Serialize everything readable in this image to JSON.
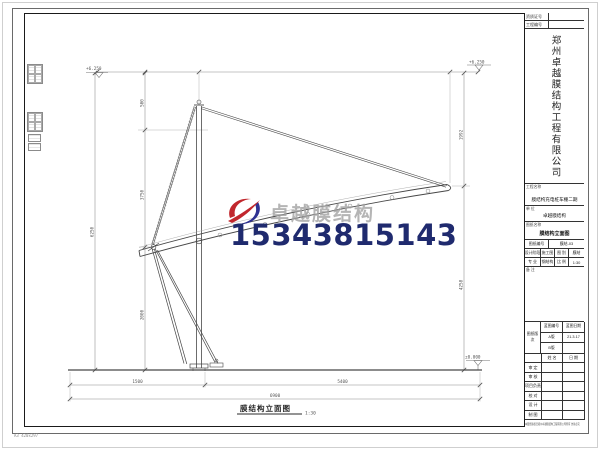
{
  "watermark": {
    "brand": "卓越膜结构",
    "phone": "15343815143",
    "brand_color": "#a3a3a3",
    "phone_color": "#1f2a6e",
    "logo_red": "#c1272d",
    "logo_blue": "#2e3192"
  },
  "drawing": {
    "caption": "膜结构立面图",
    "scale": "1:30",
    "elevations": {
      "top_left": "+6.250",
      "top_right": "+6.250",
      "ground": "±0.000"
    },
    "dims": {
      "left_total": "6250",
      "left_seg_top": "500",
      "left_seg_mid": "3750",
      "left_seg_bot": "2000",
      "right_seg_top": "1992",
      "right_seg_bot": "4258",
      "bottom_left": "1500",
      "bottom_right": "5400",
      "bottom_total": "6900"
    }
  },
  "title_block": {
    "cert_label": "资质证号",
    "cert_value": "",
    "proj_no_label": "工程编号",
    "proj_no_value": "",
    "company": "郑州卓越膜结构工程有限公司",
    "project_label": "工程名称",
    "project_value": "膜结构充电桩车棚二期",
    "unit_label": "单 位",
    "unit_value": "卓越膜结构",
    "sheet_label": "图纸名称",
    "sheet_value": "膜结构立面图",
    "grid": {
      "drawing_no_label": "图纸编号",
      "drawing_no": "膜结-03",
      "stage_label": "设计阶段",
      "stage": "施工图",
      "type_label": "图 别",
      "type": "膜结",
      "major_label": "专 业",
      "major": "钢结构",
      "scale_label": "比 例",
      "scale": "1:30",
      "note_label": "备 注"
    },
    "rev": {
      "corner": "图纸版次",
      "col1": "蓝图编号",
      "col2": "蓝图日期",
      "rows": [
        [
          "A版",
          "21.3.17"
        ],
        [
          "B版",
          ""
        ]
      ]
    },
    "sign": {
      "col_name": "姓 名",
      "col_date": "日 期",
      "rows": [
        "审 定",
        "审 核",
        "项目负责",
        "校 对",
        "设 计",
        "制 图"
      ]
    },
    "copyright": "本图纸版权归郑州卓越膜结构工程有限公司所有 仿冒必究"
  },
  "margin": {
    "paper_label": "A3 420x297"
  }
}
